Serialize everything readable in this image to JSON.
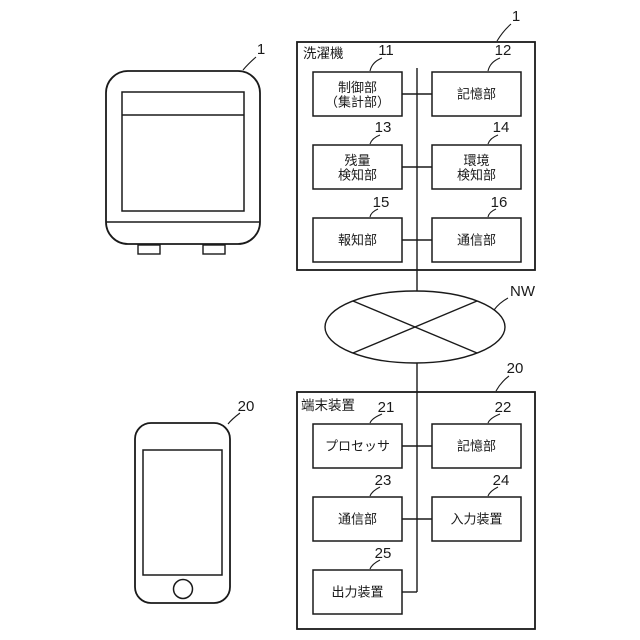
{
  "figure": {
    "washer_unit": {
      "drawing_ref": "1",
      "system_ref": "1",
      "system_title": "洗濯機",
      "blocks": [
        {
          "ref": "11",
          "lines": [
            "制御部",
            "（集計部）"
          ]
        },
        {
          "ref": "12",
          "lines": [
            "記憶部"
          ]
        },
        {
          "ref": "13",
          "lines": [
            "残量",
            "検知部"
          ]
        },
        {
          "ref": "14",
          "lines": [
            "環境",
            "検知部"
          ]
        },
        {
          "ref": "15",
          "lines": [
            "報知部"
          ]
        },
        {
          "ref": "16",
          "lines": [
            "通信部"
          ]
        }
      ]
    },
    "network": {
      "ref": "NW"
    },
    "terminal_unit": {
      "drawing_ref": "20",
      "system_ref": "20",
      "system_title": "端末装置",
      "blocks": [
        {
          "ref": "21",
          "lines": [
            "プロセッサ"
          ]
        },
        {
          "ref": "22",
          "lines": [
            "記憶部"
          ]
        },
        {
          "ref": "23",
          "lines": [
            "通信部"
          ]
        },
        {
          "ref": "24",
          "lines": [
            "入力装置"
          ]
        },
        {
          "ref": "25",
          "lines": [
            "出力装置"
          ]
        }
      ]
    },
    "colors": {
      "line": "#1a1a1a",
      "background": "#ffffff"
    }
  }
}
